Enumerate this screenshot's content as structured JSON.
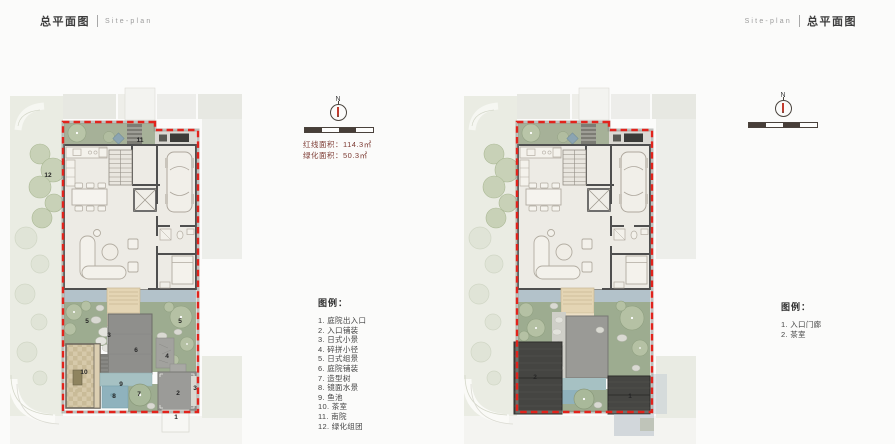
{
  "header": {
    "left": {
      "zh": "总平面图",
      "en": "Site-plan"
    },
    "right": {
      "en": "Site-plan",
      "zh": "总平面图"
    }
  },
  "compass": {
    "north": "N"
  },
  "stats": {
    "lines": [
      "红线面积：114.3㎡",
      "绿化面积：50.3㎡"
    ]
  },
  "legend_main": {
    "title": "图例：",
    "items": [
      "1. 庭院出入口",
      "2. 入口铺装",
      "3. 日式小景",
      "4. 碎拼小径",
      "5. 日式组景",
      "6. 庭院铺装",
      "7. 造型树",
      "8. 镜面水景",
      "9. 鱼池",
      "10. 茶室",
      "11. 南院",
      "12. 绿化组团"
    ]
  },
  "legend_secondary": {
    "title": "图例：",
    "items": [
      "1. 入口门廊",
      "2. 茶室"
    ]
  },
  "plan_a": {
    "markers": [
      {
        "label": "12",
        "x": 38,
        "y": 90
      },
      {
        "label": "11",
        "x": 130,
        "y": 55
      },
      {
        "label": "5",
        "x": 77,
        "y": 236
      },
      {
        "label": "5",
        "x": 170,
        "y": 236
      },
      {
        "label": "3",
        "x": 99,
        "y": 250
      },
      {
        "label": "6",
        "x": 126,
        "y": 265
      },
      {
        "label": "4",
        "x": 157,
        "y": 271
      },
      {
        "label": "10",
        "x": 74,
        "y": 287
      },
      {
        "label": "9",
        "x": 111,
        "y": 299
      },
      {
        "label": "8",
        "x": 104,
        "y": 311
      },
      {
        "label": "7",
        "x": 129,
        "y": 309
      },
      {
        "label": "2",
        "x": 168,
        "y": 308
      },
      {
        "label": "3",
        "x": 185,
        "y": 303
      },
      {
        "label": "1",
        "x": 166,
        "y": 332
      }
    ]
  },
  "plan_b": {
    "markers": [
      {
        "label": "2",
        "x": 71,
        "y": 292
      },
      {
        "label": "1",
        "x": 166,
        "y": 311
      }
    ]
  },
  "colors": {
    "boundary_red": "#e2231c",
    "garden_green": "#9dac90",
    "water_blue": "#b3c2ca",
    "roof_dark": "#454542"
  }
}
